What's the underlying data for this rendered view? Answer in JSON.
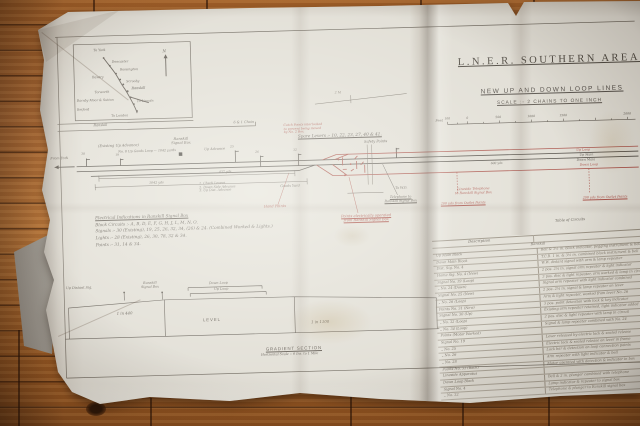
{
  "colors": {
    "ink": "#55504a",
    "red_annotation": "#a84f46",
    "paper": "#e0ddd4",
    "floor": "#b5703a"
  },
  "sheet": {
    "title": "L.N.E.R. Southern Area. Ranskill.",
    "subtitle": "New Up and Down Loop Lines",
    "scale_note": "Scale :- 2 Chains to One Inch",
    "spare_levers": "Spare Levers :- 10, 22, 23, 27, 40 & 41.",
    "scale_bar": {
      "unit": "Feet",
      "ticks": [
        "100",
        "0",
        "500",
        "1000",
        "1500",
        "2000"
      ]
    }
  },
  "key_map": {
    "stations": [
      "To York",
      "Doncaster",
      "Rossington",
      "Bawtry",
      "Scrooby",
      "Ranskill",
      "Torworth",
      "Barnby Moor & Sutton",
      "To Lincoln",
      "Retford",
      "To London"
    ],
    "north": "N",
    "caption": "Ranskill",
    "scale": "6 & 1 Chain"
  },
  "diagram": {
    "from_york": "From York",
    "existing_advance": "(Existing Up Advance)",
    "goods_loop": "No. 8 Up Goods Loop — 1042 yards",
    "up_advance": "Up Advance",
    "box1": "Ranskill",
    "box2": "Signal Box",
    "mile_mark": "2 M",
    "safety_points": "Safety Points",
    "catch_note": [
      "Catch Points interlocked",
      "to prevent being moved",
      "by No. 2 Box"
    ],
    "sig_nums": [
      "30",
      "19",
      "25",
      "26",
      "32"
    ],
    "line_labels": {
      "up_loop": "Up Loop",
      "up_main": "Up Main",
      "down_main": "Down Main",
      "down_loop": "Down Loop"
    },
    "dist437": "437 yds",
    "dist1042": "1042 yds",
    "dist600": "600 yds",
    "list": [
      "1. Check Levers",
      "2. Down Side Advance",
      "3. Up Dist. Advance"
    ],
    "goods_yard": "Goods Yard",
    "hand_points": "Hand Points",
    "to_wo": "To W.O.",
    "tel1": "Telephone to",
    "tel2": "Ranskill Signal Box",
    "elec1": "Points electrically operated",
    "elec2": "from Ranskill Signal Box",
    "lineside1": "Lineside Telephone",
    "lineside2": "to Ranskill Signal Box",
    "outlet_left": "200 yds from Outlet Points",
    "outlet_right": "200 yds from Outlet Points"
  },
  "indications": {
    "lines": [
      "Electrical Indications in Ranskill Signal Box",
      "Block Circuits :- A, B, D, E, F, G, H, J, L, M, N, O.",
      "Signals :- 30 (Existing), 19, 25, 26, 32, 34, (26) & 24. (Combined Worked & Lights.)",
      "Lights :- 28 (Existing), 26, 30, 78, 32 & 34.",
      "Points :- 31, 14 & 34."
    ]
  },
  "gradient": {
    "up_distant": "Up Distant Sig.",
    "box1": "Ranskill",
    "box2": "Signal Box",
    "down_loop": "Down Loop",
    "up_loop": "Up Loop",
    "g_left": "1 in 440",
    "g_mid": "Level",
    "g_right": "1 in 1100",
    "title": "Gradient Section",
    "scale": "Horizontal Scale :- 6 Ins. to 1 Mile"
  },
  "table": {
    "caption": "Table of Circuits",
    "header": "Description",
    "subheader": "Ranskill",
    "rows": [
      {
        "l": "Up Main Block",
        "r": "Bell & 3½ in. block indicator, pegging instrument & bell"
      },
      {
        "l": "Down Main Block",
        "r": "T.C.B. 1 in. & 3½ in. combined block instrument & bell"
      },
      {
        "l": "Dist. Sig. No. 4",
        "r": "W.W. distant signal with arm & lamp repeater"
      },
      {
        "l": "Home Sig. No. 4 (New)",
        "r": "2 pos. 2¼ in. signal arm repeater & light indicator"
      },
      {
        "l": "Signal No. 19 (Loop)",
        "r": "3 pos. disc & light repeater, arm worked & lamp in circuit"
      },
      {
        "l": "„  No. 24 (Down)",
        "r": "Signal arm repeater with light indicator combined"
      },
      {
        "l": "Signal No. 25 (New)",
        "r": "2 pos. 2¼ in. signal & lamp repeater on lever"
      },
      {
        "l": "„  No. 26 (Loop)",
        "r": "Arm & light repeater, worked from lever No. 26"
      },
      {
        "l": "Points No. 31 (New)",
        "r": "3 pos. point detection with lock & key indicator"
      },
      {
        "l": "Signal No. 30 (Up)",
        "r": "Existing arm repeater retained, light indicator added"
      },
      {
        "l": "„  No. 32 (Loop)",
        "r": "2 pos. disc & light repeater with lamp in circuit"
      },
      {
        "l": "„  No. 34 (Loop)",
        "r": "Signal & lamp repeater combined with No. 24"
      },
      {
        "l": "Points (Motor Worked)",
        "r": ""
      },
      {
        "l": "Signal No. 19",
        "r": "Lever released by electric lock & sealed release"
      },
      {
        "l": "„  No. 25",
        "r": "Electric lock & sealed release on lever in frame"
      },
      {
        "l": "„  No. 26",
        "r": "Lock bar & detection on loop connection points"
      },
      {
        "l": "„  No. 28",
        "r": "Arm repeater with light indicator & bell"
      },
      {
        "l": "Points No. 31 (Back)",
        "r": "Motor operated with detection & indicator in box"
      },
      {
        "l": "Lineside Apparatus",
        "r": ""
      },
      {
        "l": "Down Loop Block",
        "r": "Bell & 2 in. plunger combined with telephone"
      },
      {
        "l": "Signal No. 4",
        "r": "Lamp indicator & repeater to signal box"
      },
      {
        "l": "„  No. 32",
        "r": "Telephone & plunger to Ranskill signal box"
      }
    ]
  }
}
